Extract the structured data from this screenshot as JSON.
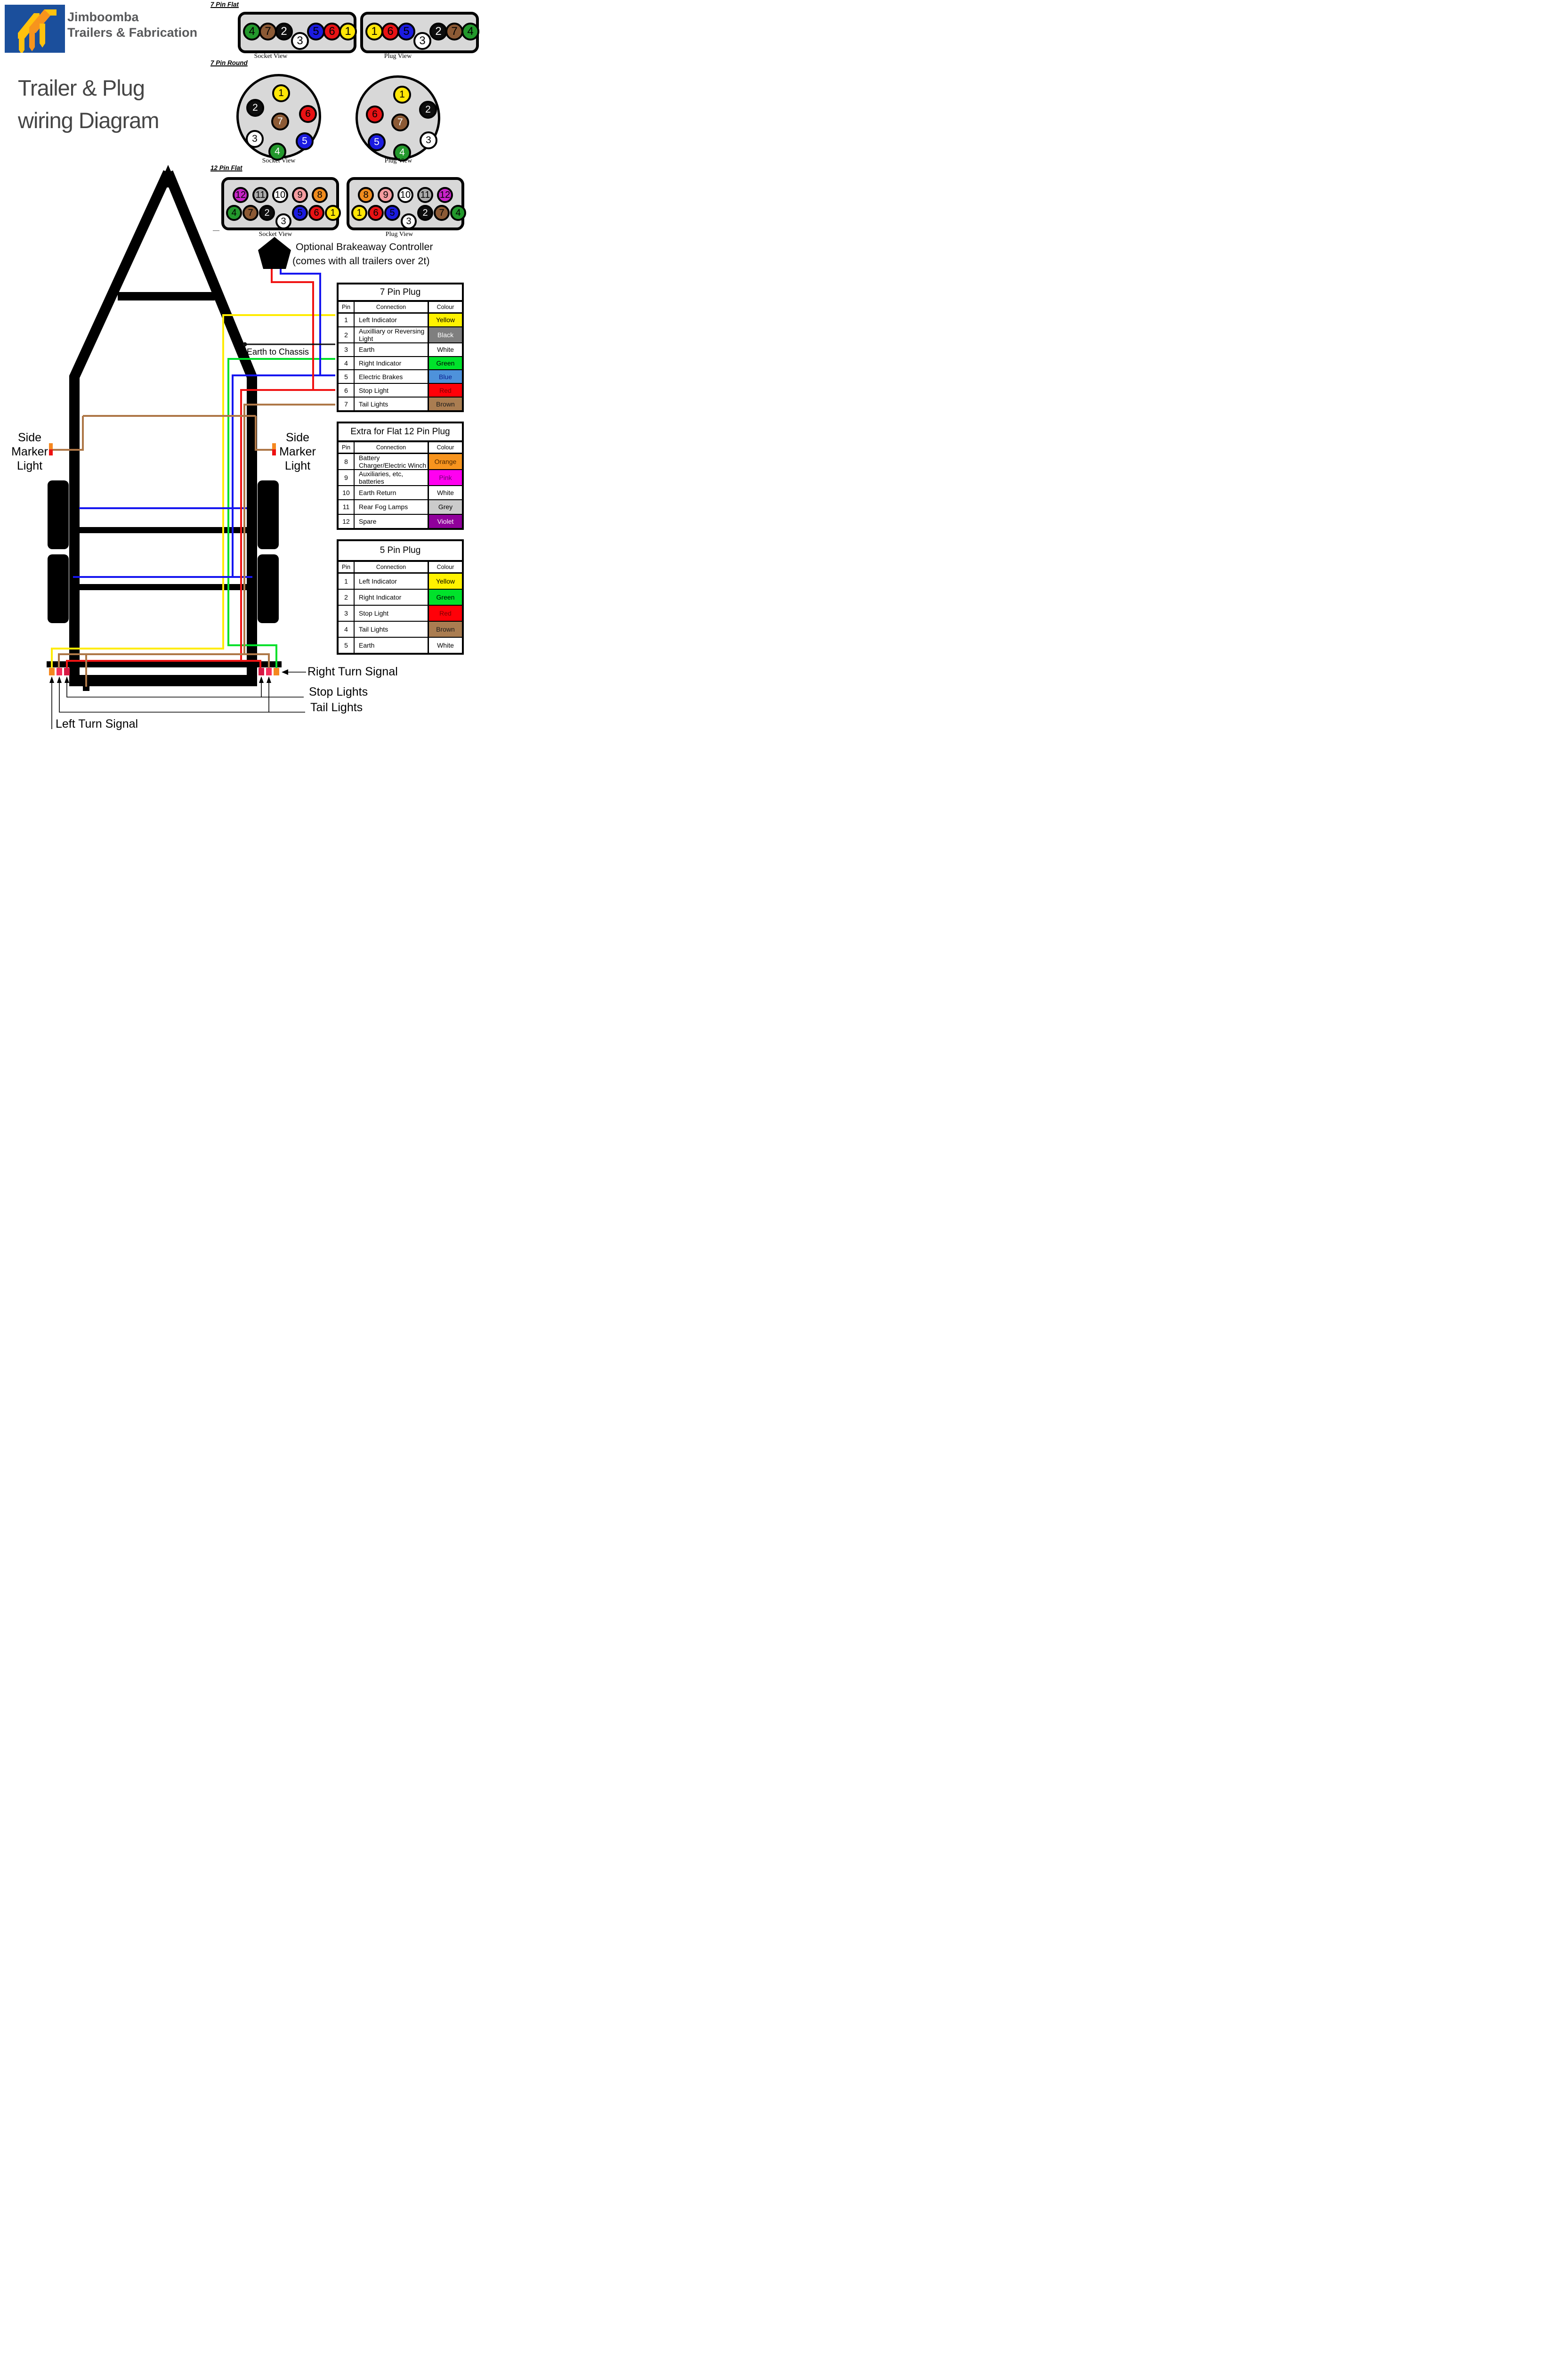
{
  "header": {
    "company_line1": "Jimboomba",
    "company_line2": "Trailers & Fabrication",
    "title_line1": "Trailer & Plug",
    "title_line2": "wiring Diagram"
  },
  "colors": {
    "yellow": "#FFE606",
    "black": "#0D0D0D",
    "white": "#FFFFFF",
    "green": "#23982C",
    "blue": "#1B1BE0",
    "red": "#E81214",
    "brown": "#8C5A35",
    "orange": "#F08C1E",
    "pink": "#F49CA0",
    "grey": "#AAAAAA",
    "magenta": "#C823C8",
    "wire_yellow": "#FFEC00",
    "wire_green": "#00E02A",
    "wire_blue": "#1616F0",
    "wire_red": "#F01414",
    "wire_brown": "#AE7747",
    "wire_black": "#111111",
    "light_orange": "#F5881F",
    "light_pink": "#F5305C",
    "light_crimson": "#D81945",
    "marker_orange": "#F5881F",
    "marker_red": "#EE1111",
    "logo_blue": "#1B4F9C",
    "connector_gray": "#D8D8D8"
  },
  "sections": {
    "seven_pin_flat": {
      "label": "7 Pin Flat",
      "socket_caption": "Socket View",
      "plug_caption": "Plug View",
      "socket_pins": [
        {
          "n": "4",
          "c": "green"
        },
        {
          "n": "7",
          "c": "brown"
        },
        {
          "n": "2",
          "c": "black",
          "fg": "#FFFFFF"
        },
        {
          "n": "3",
          "c": "white",
          "low": true
        },
        {
          "n": "5",
          "c": "blue"
        },
        {
          "n": "6",
          "c": "red"
        },
        {
          "n": "1",
          "c": "yellow"
        }
      ],
      "plug_pins": [
        {
          "n": "1",
          "c": "yellow"
        },
        {
          "n": "6",
          "c": "red"
        },
        {
          "n": "5",
          "c": "blue"
        },
        {
          "n": "3",
          "c": "white",
          "low": true
        },
        {
          "n": "2",
          "c": "black",
          "fg": "#FFFFFF"
        },
        {
          "n": "7",
          "c": "brown"
        },
        {
          "n": "4",
          "c": "green"
        }
      ]
    },
    "seven_pin_round": {
      "label": "7 Pin Round",
      "socket_caption": "Socket View",
      "plug_caption": "Plug View",
      "socket_pins": [
        {
          "n": "1",
          "c": "yellow"
        },
        {
          "n": "2",
          "c": "black",
          "fg": "#FFFFFF"
        },
        {
          "n": "6",
          "c": "red"
        },
        {
          "n": "7",
          "c": "brown",
          "fg": "#FFFFFF"
        },
        {
          "n": "3",
          "c": "white"
        },
        {
          "n": "5",
          "c": "blue",
          "fg": "#FFFFFF"
        },
        {
          "n": "4",
          "c": "green",
          "fg": "#FFFFFF"
        }
      ],
      "plug_pins": [
        {
          "n": "1",
          "c": "yellow"
        },
        {
          "n": "2",
          "c": "black",
          "fg": "#FFFFFF"
        },
        {
          "n": "6",
          "c": "red"
        },
        {
          "n": "7",
          "c": "brown",
          "fg": "#FFFFFF"
        },
        {
          "n": "3",
          "c": "white"
        },
        {
          "n": "5",
          "c": "blue",
          "fg": "#FFFFFF"
        },
        {
          "n": "4",
          "c": "green",
          "fg": "#FFFFFF"
        }
      ]
    },
    "twelve_pin_flat": {
      "label": "12 Pin Flat",
      "socket_caption": "Socket View",
      "plug_caption": "Plug View",
      "socket_top": [
        {
          "n": "12",
          "c": "magenta"
        },
        {
          "n": "11",
          "c": "grey"
        },
        {
          "n": "10",
          "c": "white"
        },
        {
          "n": "9",
          "c": "pink"
        },
        {
          "n": "8",
          "c": "orange"
        }
      ],
      "socket_bottom": [
        {
          "n": "4",
          "c": "green"
        },
        {
          "n": "7",
          "c": "brown"
        },
        {
          "n": "2",
          "c": "black",
          "fg": "#FFFFFF"
        },
        {
          "n": "3",
          "c": "white",
          "low": true
        },
        {
          "n": "5",
          "c": "blue"
        },
        {
          "n": "6",
          "c": "red"
        },
        {
          "n": "1",
          "c": "yellow"
        }
      ],
      "plug_top": [
        {
          "n": "8",
          "c": "orange"
        },
        {
          "n": "9",
          "c": "pink"
        },
        {
          "n": "10",
          "c": "white"
        },
        {
          "n": "11",
          "c": "grey"
        },
        {
          "n": "12",
          "c": "magenta"
        }
      ],
      "plug_bottom": [
        {
          "n": "1",
          "c": "yellow"
        },
        {
          "n": "6",
          "c": "red"
        },
        {
          "n": "5",
          "c": "blue"
        },
        {
          "n": "3",
          "c": "white",
          "low": true
        },
        {
          "n": "2",
          "c": "black",
          "fg": "#FFFFFF"
        },
        {
          "n": "7",
          "c": "brown"
        },
        {
          "n": "4",
          "c": "green"
        }
      ]
    }
  },
  "brakeaway": {
    "line1": "Optional Brakeaway Controller",
    "line2": "(comes with all trailers over 2t)"
  },
  "annotations": {
    "earth_to_chassis": "Earth to Chassis",
    "side_marker": [
      "Side",
      "Marker",
      "Light"
    ],
    "right_turn": "Right Turn Signal",
    "stop_lights": "Stop Lights",
    "tail_lights": "Tail Lights",
    "left_turn": "Left Turn Signal",
    "dash": "—"
  },
  "tables": [
    {
      "title": "7 Pin Plug",
      "headers": [
        "Pin",
        "Connection",
        "Colour"
      ],
      "rows": [
        {
          "pin": "1",
          "connection": "Left Indicator",
          "colour": "Yellow",
          "bg": "#FFF200",
          "fg": "#000000"
        },
        {
          "pin": "2",
          "connection": "Auxilliary or Reversing Light",
          "colour": "Black",
          "bg": "#7F7F7F",
          "fg": "#FFFFFF"
        },
        {
          "pin": "3",
          "connection": "Earth",
          "colour": "White",
          "bg": "#FFFFFF",
          "fg": "#000000"
        },
        {
          "pin": "4",
          "connection": "Right Indicator",
          "colour": "Green",
          "bg": "#00E22B",
          "fg": "#000000"
        },
        {
          "pin": "5",
          "connection": "Electric Brakes",
          "colour": "Blue",
          "bg": "#4E92DB",
          "fg": "#0B1F8F"
        },
        {
          "pin": "6",
          "connection": "Stop Light",
          "colour": "Red",
          "bg": "#FF0008",
          "fg": "#7A0000"
        },
        {
          "pin": "7",
          "connection": "Tail Lights",
          "colour": "Brown",
          "bg": "#AA7D51",
          "fg": "#1A1A1A"
        }
      ]
    },
    {
      "title": "Extra for Flat 12 Pin Plug",
      "headers": [
        "Pin",
        "Connection",
        "Colour"
      ],
      "rows": [
        {
          "pin": "8",
          "connection": "Battery Charger/Electric Winch",
          "colour": "Orange",
          "bg": "#F7941E",
          "fg": "#4D2600"
        },
        {
          "pin": "9",
          "connection": "Auxiliaries, etc, batteries",
          "colour": "Pink",
          "bg": "#FF00F0",
          "fg": "#6B006B"
        },
        {
          "pin": "10",
          "connection": "Earth Return",
          "colour": "White",
          "bg": "#FFFFFF",
          "fg": "#000000"
        },
        {
          "pin": "11",
          "connection": "Rear Fog Lamps",
          "colour": "Grey",
          "bg": "#CBCBCB",
          "fg": "#000000"
        },
        {
          "pin": "12",
          "connection": "Spare",
          "colour": "Violet",
          "bg": "#90009B",
          "fg": "#FFFFFF"
        }
      ]
    },
    {
      "title": "5 Pin  Plug",
      "headers": [
        "Pin",
        "Connection",
        "Colour"
      ],
      "rows": [
        {
          "pin": "1",
          "connection": "Left Indicator",
          "colour": "Yellow",
          "bg": "#FFF200",
          "fg": "#000000"
        },
        {
          "pin": "2",
          "connection": "Right Indicator",
          "colour": "Green",
          "bg": "#00E22B",
          "fg": "#000000"
        },
        {
          "pin": "3",
          "connection": "Stop Light",
          "colour": "Red",
          "bg": "#FF0008",
          "fg": "#7A0000"
        },
        {
          "pin": "4",
          "connection": "Tail Lights",
          "colour": "Brown",
          "bg": "#AA7D51",
          "fg": "#1A1A1A"
        },
        {
          "pin": "5",
          "connection": "Earth",
          "colour": "White",
          "bg": "#FFFFFF",
          "fg": "#000000"
        }
      ]
    }
  ]
}
